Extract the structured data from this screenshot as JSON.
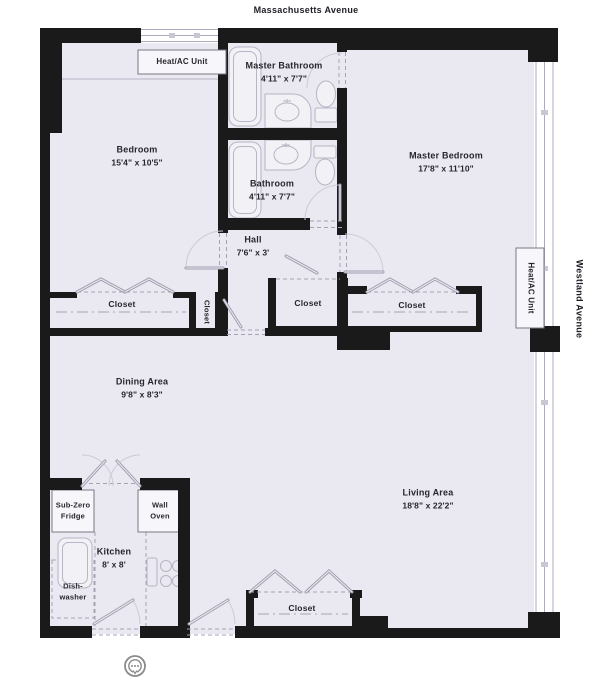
{
  "streets": {
    "top": "Massachusetts Avenue",
    "right": "Westland Avenue"
  },
  "rooms": {
    "bedroom": {
      "name": "Bedroom",
      "dims": "15'4\" x 10'5\""
    },
    "master_bathroom": {
      "name": "Master Bathroom",
      "dims": "4'11\" x 7'7\""
    },
    "bathroom": {
      "name": "Bathroom",
      "dims": "4'11\" x 7'7\""
    },
    "master_bedroom": {
      "name": "Master Bedroom",
      "dims": "17'8\" x 11'10\""
    },
    "hall": {
      "name": "Hall",
      "dims": "7'6\" x 3'"
    },
    "dining": {
      "name": "Dining Area",
      "dims": "9'8\" x 8'3\""
    },
    "living": {
      "name": "Living Area",
      "dims": "18'8\" x 22'2\""
    },
    "kitchen": {
      "name": "Kitchen",
      "dims": "8' x 8'"
    }
  },
  "closets": {
    "bedroom": "Closet",
    "hall_small": "Closet",
    "hall": "Closet",
    "master": "Closet",
    "living": "Closet"
  },
  "equipment": {
    "heat_ac_top": "Heat/AC Unit",
    "heat_ac_right": "Heat/AC Unit",
    "fridge_line1": "Sub-Zero",
    "fridge_line2": "Fridge",
    "wall_oven_line1": "Wall",
    "wall_oven_line2": "Oven",
    "dishwasher_line1": "Dish-",
    "dishwasher_line2": "washer"
  },
  "icons": {
    "bottom_control": "chat-bubble-map-control"
  },
  "colors": {
    "wall": "#1a1a1a",
    "floor": "#eae8f0",
    "text": "#26262e"
  }
}
